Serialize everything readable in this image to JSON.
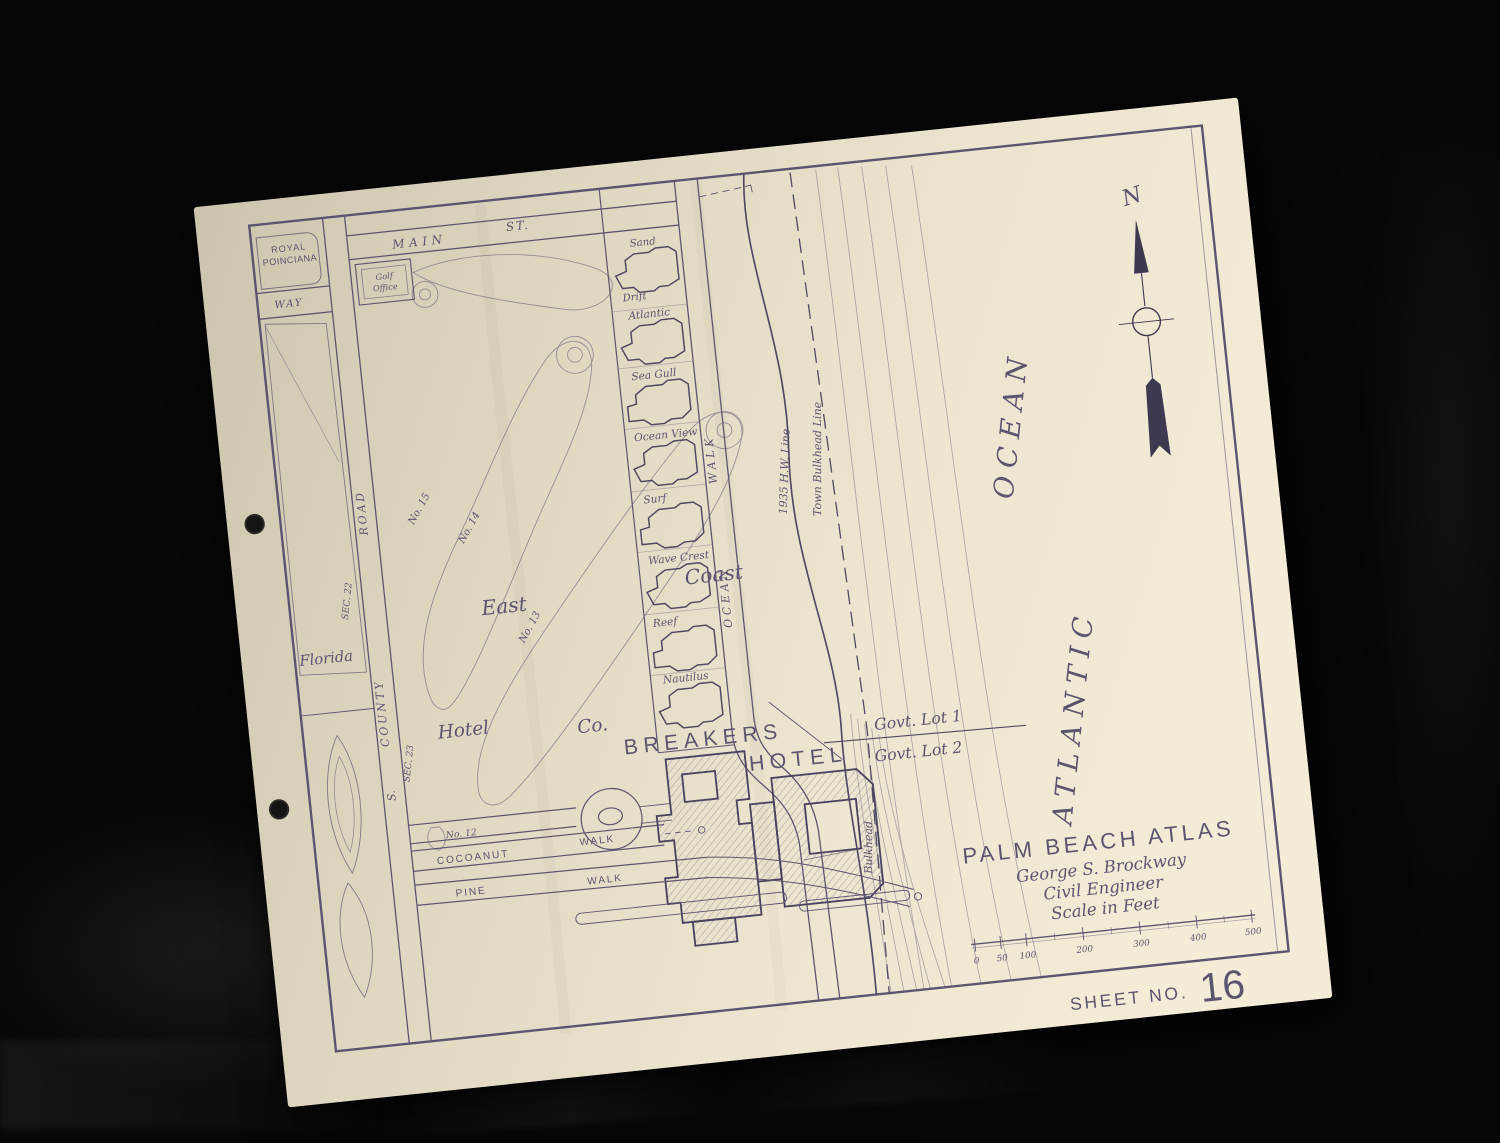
{
  "sheet": {
    "north": "N",
    "title": "PALM BEACH ATLAS",
    "author": "George  S.  Brockway",
    "author_title": "Civil Engineer",
    "scale_caption": "Scale in Feet",
    "scale_ticks": [
      "0",
      "50",
      "100",
      "200",
      "300",
      "400",
      "500"
    ],
    "sheet_label": "SHEET NO.",
    "sheet_number": "16"
  },
  "streets": {
    "main_1": "MAIN",
    "main_2": "ST.",
    "royal_1": "ROYAL",
    "royal_2": "POINCIANA",
    "way": "WAY",
    "county_s": "S.",
    "county_county": "COUNTY",
    "county_road": "ROAD",
    "ocean_walk_1": "OCEAN",
    "ocean_walk_2": "WALK",
    "cocoanut_1": "COCOANUT",
    "cocoanut_2": "WALK",
    "pine_1": "PINE",
    "pine_2": "WALK"
  },
  "areas": {
    "florida": "Florida",
    "sec22": "SEC. 22",
    "sec23": "SEC. 23",
    "east": "East",
    "coast": "Coast",
    "hotel": "Hotel",
    "co": "Co.",
    "office_1": "Golf",
    "office_2": "Office",
    "breakers": "BREAKERS",
    "hotel_big": "HOTEL",
    "govt_lot_1": "Govt. Lot 1",
    "govt_lot_2": "Govt. Lot 2",
    "atlantic": "ATLANTIC",
    "ocean": "OCEAN"
  },
  "lines": {
    "hw": "1935 H.W. Line",
    "town_bulkhead": "Town Bulkhead Line",
    "bulkhead": "Bulkhead"
  },
  "golf": {
    "hole15": "No. 15",
    "hole14": "No. 14",
    "hole13": "No. 13",
    "hole12": "No. 12"
  },
  "cottages": {
    "sand_1": "Sand",
    "sand_2": "Drift",
    "list": [
      "Atlantic",
      "Sea Gull",
      "Ocean View",
      "Surf",
      "Wave Crest",
      "Reef",
      "Nautilus"
    ]
  }
}
